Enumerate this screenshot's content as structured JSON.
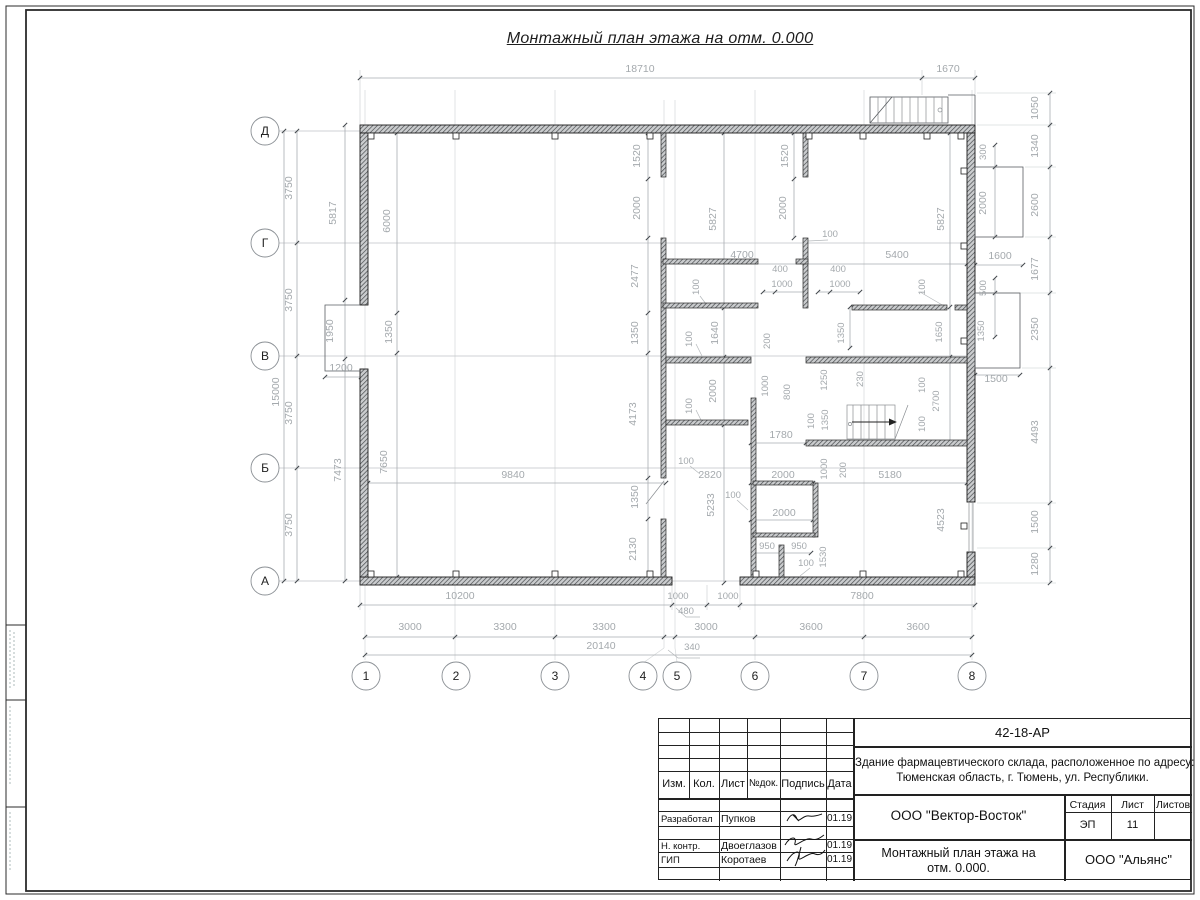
{
  "sheet": {
    "title": "Монтажный план этажа на отм. 0.000"
  },
  "axes": {
    "rows": [
      "Д",
      "Г",
      "В",
      "Б",
      "А"
    ],
    "cols": [
      "1",
      "2",
      "3",
      "4",
      "5",
      "6",
      "7",
      "8"
    ]
  },
  "plan": {
    "labels": [
      {
        "t": "18710",
        "x": 640,
        "y": 72
      },
      {
        "t": "1670",
        "x": 948,
        "y": 72
      },
      {
        "t": "1050",
        "x": 1038,
        "y": 108,
        "r": 1
      },
      {
        "t": "1340",
        "x": 1038,
        "y": 146,
        "r": 1
      },
      {
        "t": "2600",
        "x": 1038,
        "y": 205,
        "r": 1
      },
      {
        "t": "1677",
        "x": 1038,
        "y": 269,
        "r": 1
      },
      {
        "t": "2350",
        "x": 1038,
        "y": 329,
        "r": 1
      },
      {
        "t": "4493",
        "x": 1038,
        "y": 432,
        "r": 1
      },
      {
        "t": "1500",
        "x": 1038,
        "y": 522,
        "r": 1
      },
      {
        "t": "1280",
        "x": 1038,
        "y": 564,
        "r": 1
      },
      {
        "t": "300",
        "x": 986,
        "y": 152,
        "r": 1,
        "s": 1
      },
      {
        "t": "2000",
        "x": 986,
        "y": 203,
        "r": 1
      },
      {
        "t": "1600",
        "x": 1000,
        "y": 259
      },
      {
        "t": "500",
        "x": 986,
        "y": 288,
        "r": 1,
        "s": 1
      },
      {
        "t": "1350",
        "x": 984,
        "y": 331,
        "r": 1,
        "s": 1
      },
      {
        "t": "1500",
        "x": 996,
        "y": 382
      },
      {
        "t": "3750",
        "x": 292,
        "y": 188,
        "r": 1
      },
      {
        "t": "3750",
        "x": 292,
        "y": 300,
        "r": 1
      },
      {
        "t": "3750",
        "x": 292,
        "y": 413,
        "r": 1
      },
      {
        "t": "3750",
        "x": 292,
        "y": 525,
        "r": 1
      },
      {
        "t": "15000",
        "x": 279,
        "y": 392,
        "r": 1
      },
      {
        "t": "5817",
        "x": 336,
        "y": 213,
        "r": 1
      },
      {
        "t": "1950",
        "x": 333,
        "y": 331,
        "r": 1
      },
      {
        "t": "7473",
        "x": 341,
        "y": 470,
        "r": 1
      },
      {
        "t": "1200",
        "x": 341,
        "y": 371
      },
      {
        "t": "6000",
        "x": 390,
        "y": 221,
        "r": 1
      },
      {
        "t": "1350",
        "x": 392,
        "y": 332,
        "r": 1
      },
      {
        "t": "7650",
        "x": 387,
        "y": 462,
        "r": 1
      },
      {
        "t": "1520",
        "x": 640,
        "y": 156,
        "r": 1
      },
      {
        "t": "2000",
        "x": 640,
        "y": 208,
        "r": 1
      },
      {
        "t": "2477",
        "x": 638,
        "y": 276,
        "r": 1
      },
      {
        "t": "1350",
        "x": 638,
        "y": 333,
        "r": 1
      },
      {
        "t": "4173",
        "x": 636,
        "y": 414,
        "r": 1
      },
      {
        "t": "1350",
        "x": 638,
        "y": 497,
        "r": 1
      },
      {
        "t": "2130",
        "x": 636,
        "y": 549,
        "r": 1
      },
      {
        "t": "5827",
        "x": 716,
        "y": 219,
        "r": 1
      },
      {
        "t": "1640",
        "x": 718,
        "y": 333,
        "r": 1
      },
      {
        "t": "2000",
        "x": 716,
        "y": 391,
        "r": 1
      },
      {
        "t": "5233",
        "x": 714,
        "y": 505,
        "r": 1
      },
      {
        "t": "1520",
        "x": 788,
        "y": 156,
        "r": 1
      },
      {
        "t": "2000",
        "x": 786,
        "y": 208,
        "r": 1
      },
      {
        "t": "5827",
        "x": 944,
        "y": 219,
        "r": 1
      },
      {
        "t": "4700",
        "x": 742,
        "y": 258
      },
      {
        "t": "5400",
        "x": 897,
        "y": 258
      },
      {
        "t": "400",
        "x": 780,
        "y": 272,
        "s": 1
      },
      {
        "t": "1000",
        "x": 782,
        "y": 287,
        "s": 1
      },
      {
        "t": "400",
        "x": 838,
        "y": 272,
        "s": 1
      },
      {
        "t": "1000",
        "x": 840,
        "y": 287,
        "s": 1
      },
      {
        "t": "100",
        "x": 699,
        "y": 287,
        "r": 1,
        "s": 1
      },
      {
        "t": "100",
        "x": 830,
        "y": 237,
        "s": 1
      },
      {
        "t": "100",
        "x": 925,
        "y": 287,
        "r": 1,
        "s": 1
      },
      {
        "t": "100",
        "x": 692,
        "y": 339,
        "r": 1,
        "s": 1
      },
      {
        "t": "200",
        "x": 770,
        "y": 341,
        "r": 1,
        "s": 1
      },
      {
        "t": "100",
        "x": 692,
        "y": 406,
        "r": 1,
        "s": 1
      },
      {
        "t": "1000",
        "x": 768,
        "y": 386,
        "r": 1,
        "s": 1
      },
      {
        "t": "800",
        "x": 790,
        "y": 392,
        "r": 1,
        "s": 1
      },
      {
        "t": "1250",
        "x": 827,
        "y": 380,
        "r": 1,
        "s": 1
      },
      {
        "t": "1350",
        "x": 828,
        "y": 420,
        "r": 1,
        "s": 1
      },
      {
        "t": "100",
        "x": 814,
        "y": 421,
        "r": 1,
        "s": 1
      },
      {
        "t": "1350",
        "x": 844,
        "y": 333,
        "r": 1,
        "s": 1
      },
      {
        "t": "230",
        "x": 863,
        "y": 379,
        "r": 1,
        "s": 1
      },
      {
        "t": "1650",
        "x": 942,
        "y": 332,
        "r": 1,
        "s": 1
      },
      {
        "t": "100",
        "x": 925,
        "y": 385,
        "r": 1,
        "s": 1
      },
      {
        "t": "2700",
        "x": 939,
        "y": 401,
        "r": 1,
        "s": 1
      },
      {
        "t": "100",
        "x": 925,
        "y": 424,
        "r": 1,
        "s": 1
      },
      {
        "t": "1780",
        "x": 781,
        "y": 438
      },
      {
        "t": "100",
        "x": 686,
        "y": 464,
        "s": 1
      },
      {
        "t": "100",
        "x": 733,
        "y": 498,
        "s": 1
      },
      {
        "t": "9840",
        "x": 513,
        "y": 478
      },
      {
        "t": "2820",
        "x": 710,
        "y": 478
      },
      {
        "t": "2000",
        "x": 783,
        "y": 478
      },
      {
        "t": "5180",
        "x": 890,
        "y": 478
      },
      {
        "t": "2000",
        "x": 784,
        "y": 516
      },
      {
        "t": "1000",
        "x": 827,
        "y": 469,
        "r": 1,
        "s": 1
      },
      {
        "t": "200",
        "x": 846,
        "y": 470,
        "r": 1,
        "s": 1
      },
      {
        "t": "950",
        "x": 767,
        "y": 549,
        "s": 1
      },
      {
        "t": "950",
        "x": 799,
        "y": 549,
        "s": 1
      },
      {
        "t": "100",
        "x": 806,
        "y": 566,
        "s": 1
      },
      {
        "t": "1530",
        "x": 826,
        "y": 557,
        "r": 1,
        "s": 1
      },
      {
        "t": "4523",
        "x": 944,
        "y": 520,
        "r": 1
      },
      {
        "t": "10200",
        "x": 460,
        "y": 599
      },
      {
        "t": "1000",
        "x": 678,
        "y": 599,
        "s": 1
      },
      {
        "t": "1000",
        "x": 728,
        "y": 599,
        "s": 1
      },
      {
        "t": "7800",
        "x": 862,
        "y": 599
      },
      {
        "t": "480",
        "x": 686,
        "y": 614,
        "s": 1
      },
      {
        "t": "3000",
        "x": 410,
        "y": 630
      },
      {
        "t": "3300",
        "x": 505,
        "y": 630
      },
      {
        "t": "3300",
        "x": 604,
        "y": 630
      },
      {
        "t": "3000",
        "x": 706,
        "y": 630
      },
      {
        "t": "3600",
        "x": 811,
        "y": 630
      },
      {
        "t": "3600",
        "x": 918,
        "y": 630
      },
      {
        "t": "340",
        "x": 692,
        "y": 650,
        "s": 1
      },
      {
        "t": "20140",
        "x": 601,
        "y": 649
      }
    ]
  },
  "title_block": {
    "doc_code": "42-18-АР",
    "object_line1": "Здание фармацевтического склада, расположенное по адресу:",
    "object_line2": "Тюменская область, г. Тюмень, ул. Республики.",
    "org": "ООО \"Вектор-Восток\"",
    "sheet_title_line1": "Монтажный план этажа на",
    "sheet_title_line2": "отм. 0.000.",
    "company": "ООО \"Альянс\"",
    "stage_label": "Стадия",
    "stage_value": "ЭП",
    "sheet_label": "Лист",
    "sheet_value": "11",
    "sheets_label": "Листов",
    "sheets_value": "",
    "header": {
      "izm": "Изм.",
      "kol": "Кол.",
      "list": "Лист",
      "ndok": "№док.",
      "podpis": "Подпись",
      "data": "Дата"
    },
    "rows": [
      {
        "role": "Разработал",
        "name": "Пупков",
        "date": "01.19"
      },
      {
        "role": "Н. контр.",
        "name": "Двоеглазов",
        "date": "01.19"
      },
      {
        "role": "ГИП",
        "name": "Коротаев",
        "date": "01.19"
      }
    ]
  }
}
